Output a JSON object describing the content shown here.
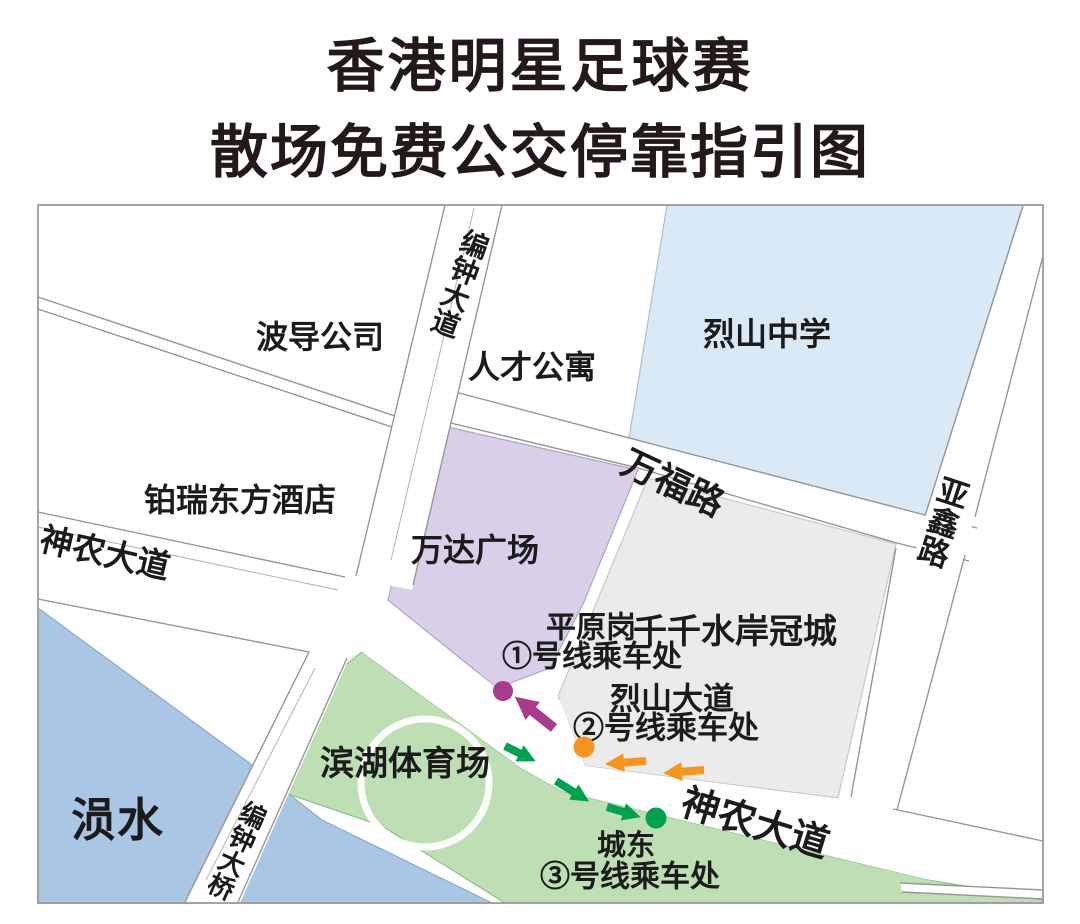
{
  "title": {
    "line1": "香港明星足球赛",
    "line2": "散场免费公交停靠指引图"
  },
  "map": {
    "places": [
      {
        "id": "bodao-company",
        "label": "波导公司"
      },
      {
        "id": "rencai-apartments",
        "label": "人才公寓"
      },
      {
        "id": "lieshan-middle-school",
        "label": "烈山中学"
      },
      {
        "id": "borui-oriental-hotel",
        "label": "铂瑞东方酒店"
      },
      {
        "id": "wanda-plaza",
        "label": "万达广场"
      },
      {
        "id": "qianqian-shuian-guancheng",
        "label": "千千水岸冠城"
      },
      {
        "id": "binhu-stadium",
        "label": "滨湖体育场"
      },
      {
        "id": "yun-river",
        "label": "涢水"
      }
    ],
    "roads": [
      {
        "id": "bianzhong-avenue",
        "label": "编钟大道"
      },
      {
        "id": "bianzhong-bridge",
        "label": "编钟大桥"
      },
      {
        "id": "shennong-avenue-west",
        "label": "神农大道"
      },
      {
        "id": "shennong-avenue-southeast",
        "label": "神农大道"
      },
      {
        "id": "wanfu-road",
        "label": "万福路"
      },
      {
        "id": "yaxin-road",
        "label": "亚鑫路"
      }
    ],
    "stops": [
      {
        "id": "line-1",
        "area_label": "平原岗",
        "stop_label": "①号线乘车处",
        "color": "#A93A8C"
      },
      {
        "id": "line-2",
        "area_label": "烈山大道",
        "stop_label": "②号线乘车处",
        "color": "#F7941E"
      },
      {
        "id": "line-3",
        "area_label": "城东",
        "stop_label": "③号线乘车处",
        "color": "#00A24F"
      }
    ],
    "colors": {
      "school_area": "#D9EAF6",
      "plaza_area": "#D9CFE8",
      "guancheng_area": "#EBEBEC",
      "stadium_area": "#BEDFB4",
      "water": "#A9C6E5",
      "line1_magenta": "#A93A8C",
      "line2_orange": "#F7941E",
      "line3_green": "#00A24F"
    }
  }
}
